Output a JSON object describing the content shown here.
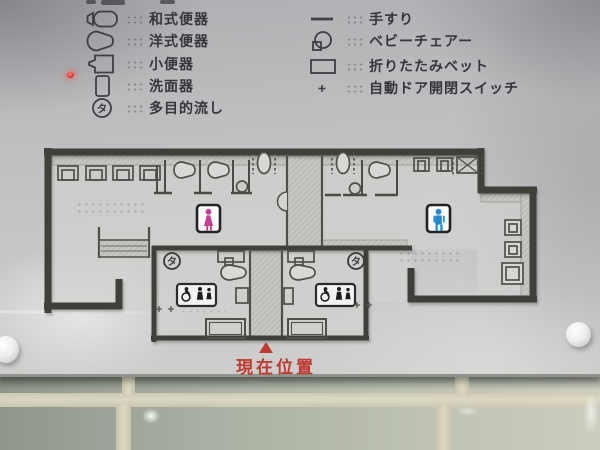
{
  "legend": {
    "left_items": [
      {
        "icon": "squat-toilet-icon",
        "label": "和式便器"
      },
      {
        "icon": "western-toilet-icon",
        "label": "洋式便器"
      },
      {
        "icon": "urinal-icon",
        "label": "小便器"
      },
      {
        "icon": "washbasin-icon",
        "label": "洗面器"
      },
      {
        "icon": "multipurpose-sink-icon",
        "label": "多目的流し",
        "marker": "タ"
      }
    ],
    "right_items": [
      {
        "icon": "handrail-icon",
        "label": "手すり"
      },
      {
        "icon": "baby-chair-icon",
        "label": "ベビーチェアー"
      },
      {
        "icon": "folding-bed-icon",
        "label": "折りたたみベット"
      },
      {
        "icon": "auto-door-switch-icon",
        "label": "自動ドア開閉スイッチ"
      }
    ]
  },
  "map": {
    "current_location_label": "現在位置",
    "current_location_color": "#bf3a30",
    "multipurpose_sink_marker": "タ",
    "womens_room": {
      "icon": "woman-pictogram",
      "color": "#c73e93"
    },
    "mens_room": {
      "icon": "man-pictogram",
      "color": "#2388cd"
    },
    "accessible_rooms_icon": "wheelchair-adult-child-pictogram"
  }
}
